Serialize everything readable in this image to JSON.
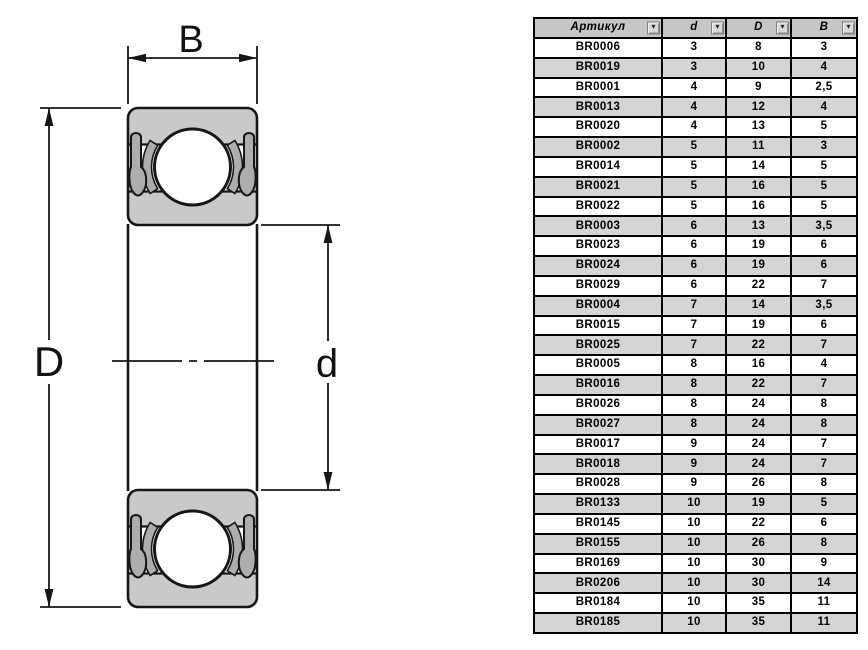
{
  "diagram": {
    "labels": {
      "width": "B",
      "outer_diameter": "D",
      "bore_diameter": "d"
    }
  },
  "icons": {
    "filter_dropdown": "▾"
  },
  "table": {
    "columns": [
      "Артикул",
      "d",
      "D",
      "B"
    ],
    "rows": [
      [
        "BR0006",
        "3",
        "8",
        "3"
      ],
      [
        "BR0019",
        "3",
        "10",
        "4"
      ],
      [
        "BR0001",
        "4",
        "9",
        "2,5"
      ],
      [
        "BR0013",
        "4",
        "12",
        "4"
      ],
      [
        "BR0020",
        "4",
        "13",
        "5"
      ],
      [
        "BR0002",
        "5",
        "11",
        "3"
      ],
      [
        "BR0014",
        "5",
        "14",
        "5"
      ],
      [
        "BR0021",
        "5",
        "16",
        "5"
      ],
      [
        "BR0022",
        "5",
        "16",
        "5"
      ],
      [
        "BR0003",
        "6",
        "13",
        "3,5"
      ],
      [
        "BR0023",
        "6",
        "19",
        "6"
      ],
      [
        "BR0024",
        "6",
        "19",
        "6"
      ],
      [
        "BR0029",
        "6",
        "22",
        "7"
      ],
      [
        "BR0004",
        "7",
        "14",
        "3,5"
      ],
      [
        "BR0015",
        "7",
        "19",
        "6"
      ],
      [
        "BR0025",
        "7",
        "22",
        "7"
      ],
      [
        "BR0005",
        "8",
        "16",
        "4"
      ],
      [
        "BR0016",
        "8",
        "22",
        "7"
      ],
      [
        "BR0026",
        "8",
        "24",
        "8"
      ],
      [
        "BR0027",
        "8",
        "24",
        "8"
      ],
      [
        "BR0017",
        "9",
        "24",
        "7"
      ],
      [
        "BR0018",
        "9",
        "24",
        "7"
      ],
      [
        "BR0028",
        "9",
        "26",
        "8"
      ],
      [
        "BR0133",
        "10",
        "19",
        "5"
      ],
      [
        "BR0145",
        "10",
        "22",
        "6"
      ],
      [
        "BR0155",
        "10",
        "26",
        "8"
      ],
      [
        "BR0169",
        "10",
        "30",
        "9"
      ],
      [
        "BR0206",
        "10",
        "30",
        "14"
      ],
      [
        "BR0184",
        "10",
        "35",
        "11"
      ],
      [
        "BR0185",
        "10",
        "35",
        "11"
      ]
    ]
  },
  "colors": {
    "bearing_fill": "#c9c9c9",
    "bearing_detail": "#adadad",
    "line": "#161616",
    "header_bg": "#c6c6c6",
    "row_alt_bg": "#d4d4d4",
    "row_bg": "#ffffff",
    "border": "#000000"
  }
}
